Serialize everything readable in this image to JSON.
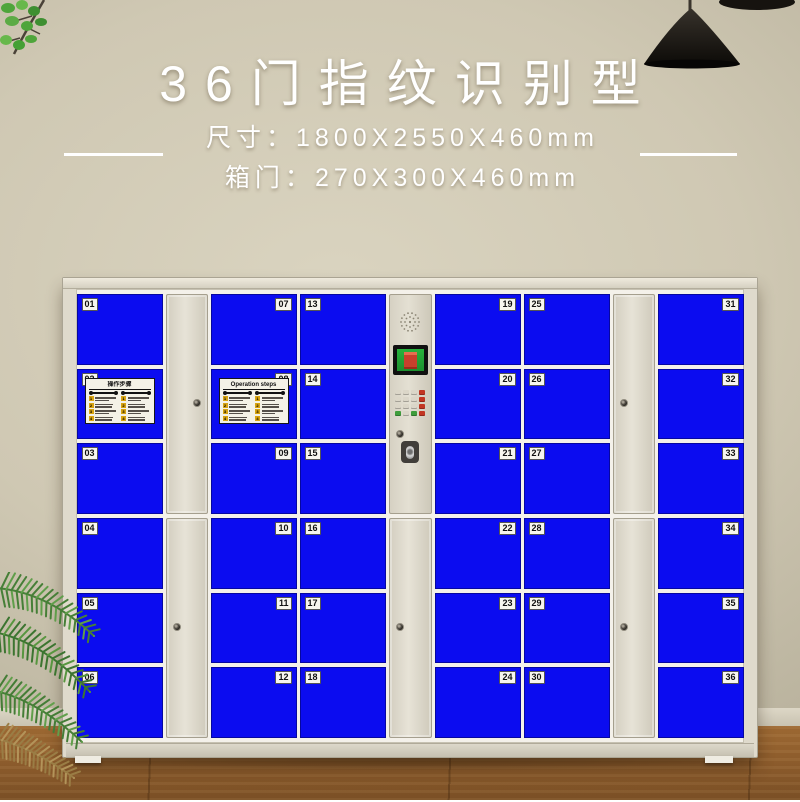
{
  "header": {
    "title": "36门指纹识别型",
    "specs": [
      {
        "label": "尺寸：",
        "value": "1800X2550X460mm"
      },
      {
        "label": "箱门：",
        "value": "270X300X460mm"
      }
    ]
  },
  "locker": {
    "columns": [
      {
        "type": "doors",
        "side": "left",
        "doors": [
          "01",
          "02",
          "03",
          "04",
          "05",
          "06"
        ]
      },
      {
        "type": "tall",
        "locks": [
          "right",
          "left"
        ]
      },
      {
        "type": "doors",
        "side": "right",
        "doors": [
          "07",
          "08",
          "09",
          "10",
          "11",
          "12"
        ]
      },
      {
        "type": "doors",
        "side": "left",
        "doors": [
          "13",
          "14",
          "15",
          "16",
          "17",
          "18"
        ]
      },
      {
        "type": "control"
      },
      {
        "type": "doors",
        "side": "right",
        "doors": [
          "19",
          "20",
          "21",
          "22",
          "23",
          "24"
        ]
      },
      {
        "type": "doors",
        "side": "left",
        "doors": [
          "25",
          "26",
          "27",
          "28",
          "29",
          "30"
        ]
      },
      {
        "type": "tall",
        "locks": [
          "left",
          "left"
        ]
      },
      {
        "type": "doors",
        "side": "right",
        "doors": [
          "31",
          "32",
          "33",
          "34",
          "35",
          "36"
        ]
      }
    ],
    "stickers": [
      {
        "door": "02",
        "title": "操作步骤",
        "columns": 2,
        "steps_per_column": 4
      },
      {
        "door": "08",
        "title": "Operation steps",
        "columns": 2,
        "steps_per_column": 4
      }
    ],
    "control": {
      "keypad_rows": 4,
      "keypad_cols": 4
    }
  },
  "colors": {
    "door_blue": "#0b0cf0",
    "accent_red": "#c23522",
    "key_green": "#3f9d3c",
    "screen_green": "#27b33c",
    "screen_red": "#c8402c",
    "sticker_yellow": "#d8a411",
    "wall_beige": "#cfc8b3",
    "floor_brown": "#8a5a2b"
  }
}
